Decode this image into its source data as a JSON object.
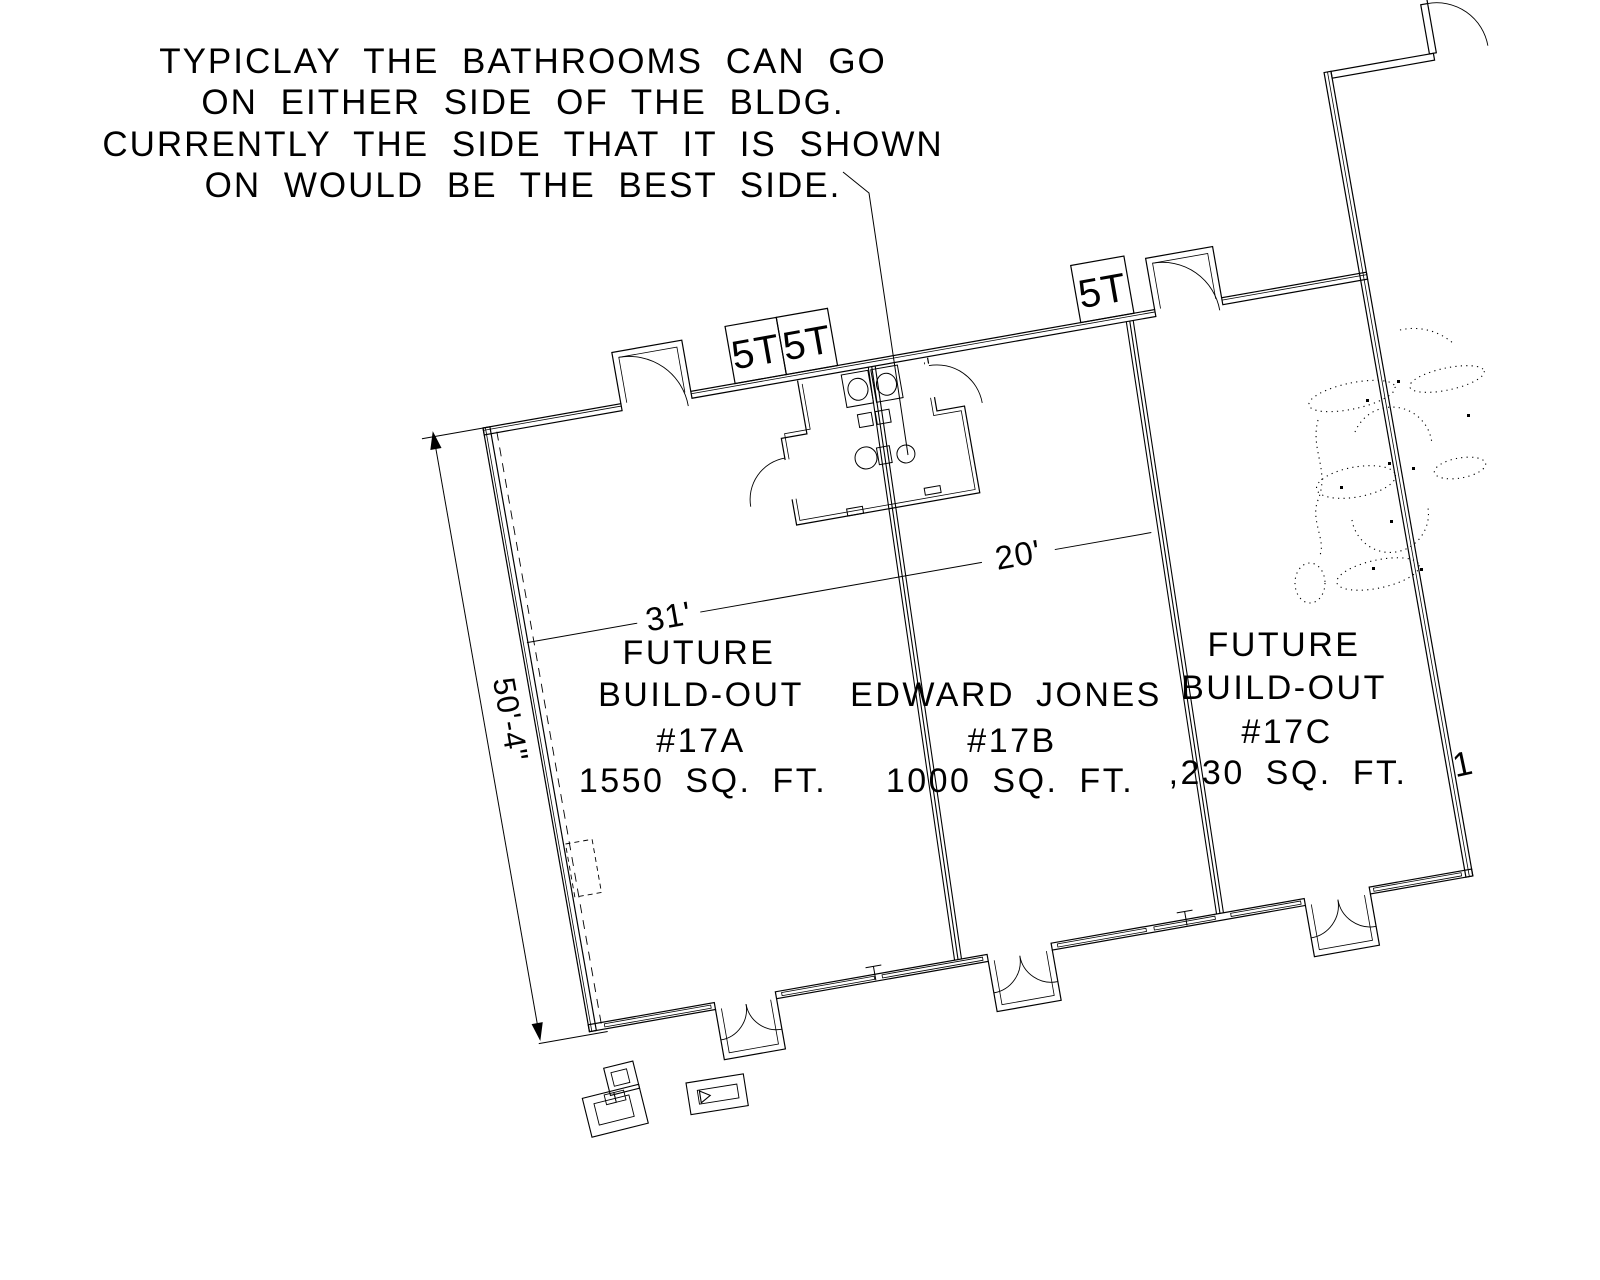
{
  "drawing": {
    "annotation": {
      "lines": [
        "TYPICLAY THE BATHROOMS CAN GO",
        "ON EITHER SIDE OF THE BLDG.",
        "CURRENTLY THE SIDE THAT IT IS SHOWN",
        "ON WOULD BE THE BEST SIDE."
      ]
    },
    "units": [
      {
        "label_lines": [
          "FUTURE",
          "BUILD-OUT"
        ],
        "number": "#17A",
        "area": "1550 SQ. FT."
      },
      {
        "label_lines": [
          "EDWARD JONES"
        ],
        "number": "#17B",
        "area": "1000 SQ. FT."
      },
      {
        "label_lines": [
          "FUTURE",
          "BUILD-OUT"
        ],
        "number": "#17C",
        "area": ",230 SQ. FT.",
        "area_overflow_digit": "1"
      }
    ],
    "dimensions": {
      "left_wall": "50'-4\"",
      "unit_a_width": "31'",
      "unit_b_width": "20'"
    },
    "tags": {
      "pair_left": [
        "5T",
        "5T"
      ],
      "single_right": "5T"
    },
    "colors": {
      "ink": "#000000",
      "background": "#ffffff"
    }
  }
}
